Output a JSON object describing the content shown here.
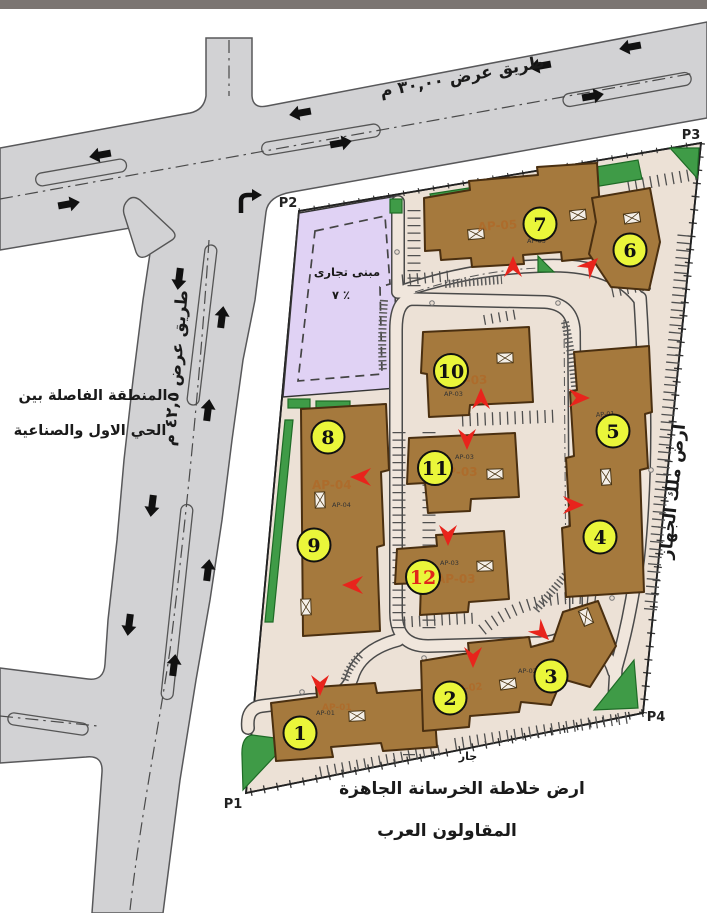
{
  "map": {
    "top_road_label": "طريق عرض ٣٠,٠٠ م",
    "left_road_label": "طريق عرض ٤٢,٥ م",
    "buffer_zone_line1": "المنطقة الفاصلة بين",
    "buffer_zone_line2": "الحي الاول والصناعية",
    "east_parcel_label": "ارض ملك الجهاز",
    "south_neighbor_small": "جار",
    "south_parcel_line1": "ارض خلاطة الخرسانة الجاهزة",
    "south_parcel_line2": "المقاولون العرب",
    "commercial_parcel_line1": "مبنى تجارى",
    "commercial_parcel_line2": "٧ ٪",
    "corners": {
      "p1": "P1",
      "p2": "P2",
      "p3": "P3",
      "p4": "P4"
    },
    "building_numbers": [
      "1",
      "2",
      "3",
      "4",
      "5",
      "6",
      "7",
      "8",
      "9",
      "10",
      "11",
      "12"
    ],
    "ap_labels": {
      "b1": "AP-01",
      "b23": "AP-02",
      "b10": "AP-03",
      "b11": "AP-03",
      "b12": "AP-03",
      "b89": "AP-04",
      "b7": "AP-05",
      "b45": "AP-01"
    },
    "colors": {
      "road_gray": "#d2d2d4",
      "ground_beige": "#ece1d6",
      "commercial_purple": "#e0d2f4",
      "building_brown": "#a5793d",
      "badge_yellow": "#eaf63a",
      "landscape_green": "#3f9b47",
      "entrance_arrow_red": "#e8241c"
    }
  }
}
